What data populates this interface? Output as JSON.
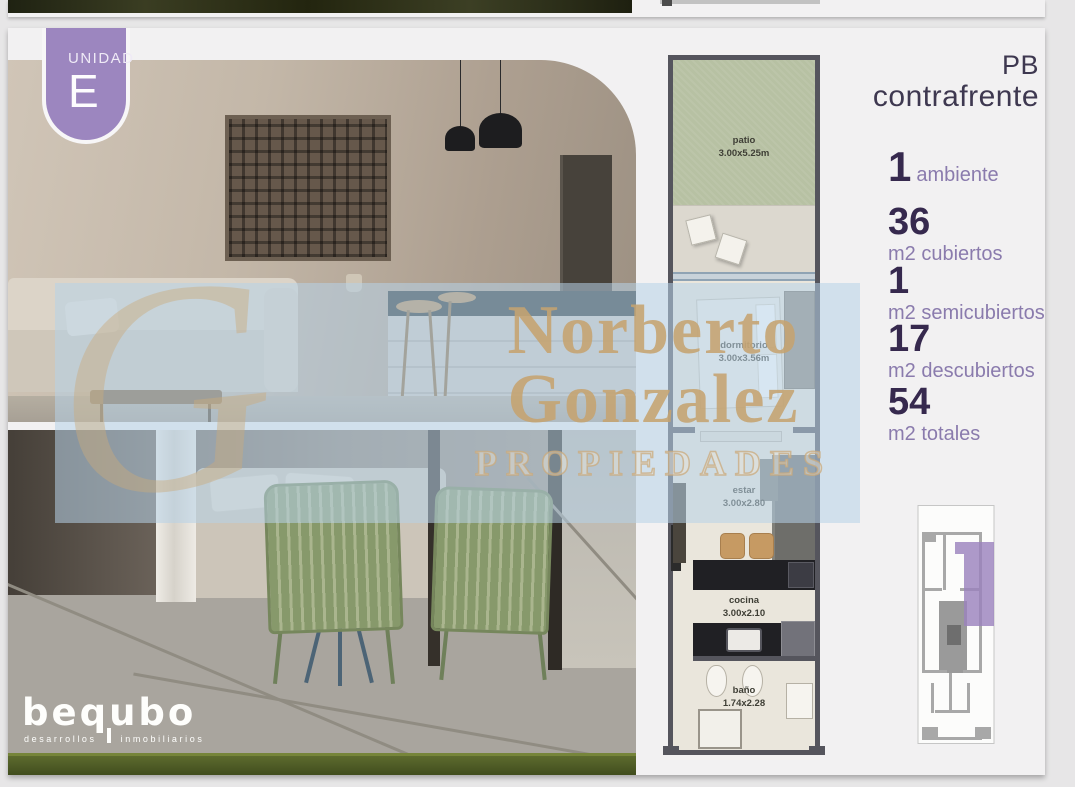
{
  "unit": {
    "badge_label": "UNIDAD",
    "badge_letter": "E",
    "level": "PB",
    "orientation": "contrafrente"
  },
  "stats": [
    {
      "value": "1",
      "label": "ambiente"
    },
    {
      "value": "36",
      "label": "m2 cubiertos"
    },
    {
      "value": "1",
      "label": "m2 semicubiertos"
    },
    {
      "value": "17",
      "label": "m2 descubiertos"
    },
    {
      "value": "54",
      "label": "m2 totales"
    }
  ],
  "floor_plan": {
    "rooms": [
      {
        "name": "patio",
        "dims": "3.00x5.25m"
      },
      {
        "name": "dormitorio",
        "dims": "3.00x3.56m"
      },
      {
        "name": "estar",
        "dims": "3.00x2.80"
      },
      {
        "name": "cocina",
        "dims": "3.00x2.10"
      },
      {
        "name": "baño",
        "dims": "1.74x2.28"
      }
    ]
  },
  "watermark": {
    "line1": "Norberto",
    "line2": "Gonzalez",
    "line3": "PROPIEDADES",
    "monogram": "G"
  },
  "brand": {
    "name": "bequbo",
    "tagline_left": "desarrollos",
    "tagline_right": "inmobiliarios"
  },
  "colors": {
    "accent_purple": "#9c86bf",
    "number_dark": "#36294e",
    "label_purple": "#8a7bad",
    "key_plan_highlight": "#9b82bd",
    "watermark_tan": "#c5a370",
    "watermark_blue": "rgba(183,209,231,0.55)"
  }
}
